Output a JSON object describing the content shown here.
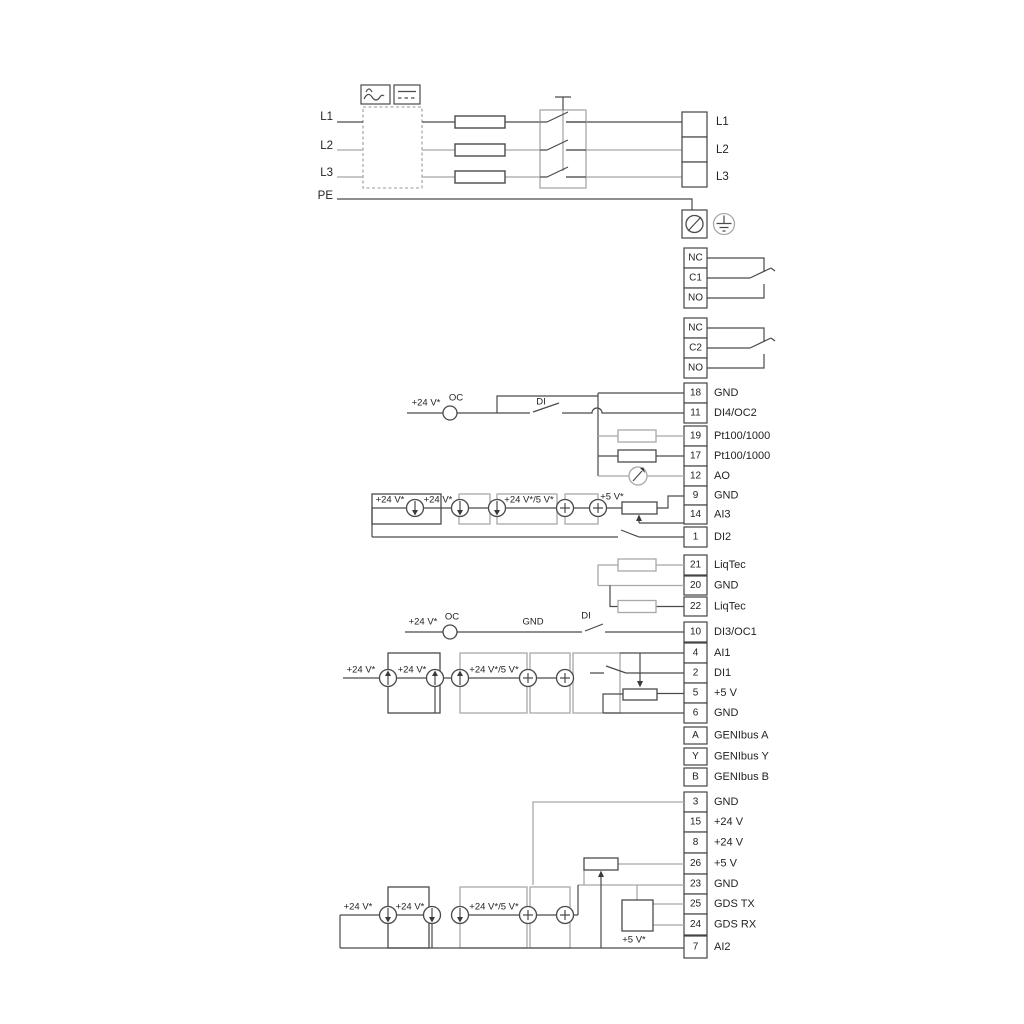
{
  "power": {
    "inputs": [
      "L1",
      "L2",
      "L3",
      "PE"
    ],
    "outputs": [
      "L1",
      "L2",
      "L3"
    ]
  },
  "relays": {
    "relay1": [
      "NC",
      "C1",
      "NO"
    ],
    "relay2": [
      "NC",
      "C2",
      "NO"
    ]
  },
  "strip1": [
    {
      "num": "18",
      "label": "GND"
    },
    {
      "num": "11",
      "label": "DI4/OC2"
    },
    {
      "num": "19",
      "label": "Pt100/1000"
    },
    {
      "num": "17",
      "label": "Pt100/1000"
    },
    {
      "num": "12",
      "label": "AO"
    },
    {
      "num": "9",
      "label": "GND"
    },
    {
      "num": "14",
      "label": "AI3"
    },
    {
      "num": "1",
      "label": "DI2"
    }
  ],
  "liqtec": [
    {
      "num": "21",
      "label": "LiqTec"
    },
    {
      "num": "20",
      "label": "GND"
    },
    {
      "num": "22",
      "label": "LiqTec"
    }
  ],
  "strip2": [
    {
      "num": "10",
      "label": "DI3/OC1"
    },
    {
      "num": "4",
      "label": "AI1"
    },
    {
      "num": "2",
      "label": "DI1"
    },
    {
      "num": "5",
      "label": "+5 V"
    },
    {
      "num": "6",
      "label": "GND"
    },
    {
      "num": "A",
      "label": "GENIbus A"
    },
    {
      "num": "Y",
      "label": "GENIbus Y"
    },
    {
      "num": "B",
      "label": "GENIbus B"
    }
  ],
  "strip3": [
    {
      "num": "3",
      "label": "GND"
    },
    {
      "num": "15",
      "label": "+24 V"
    },
    {
      "num": "8",
      "label": "+24 V"
    },
    {
      "num": "26",
      "label": "+5 V"
    },
    {
      "num": "23",
      "label": "GND"
    },
    {
      "num": "25",
      "label": "GDS TX"
    },
    {
      "num": "24",
      "label": "GDS RX"
    },
    {
      "num": "7",
      "label": "AI2"
    }
  ],
  "ann": {
    "p24": "+24 V*",
    "oc": "OC",
    "di": "DI",
    "gnd": "GND",
    "p24_5": "+24 V*/5 V*",
    "p5": "+5 V*"
  },
  "colors": {
    "line": "#4a4a4a",
    "gray": "#a8a8a8",
    "text": "#232323"
  }
}
